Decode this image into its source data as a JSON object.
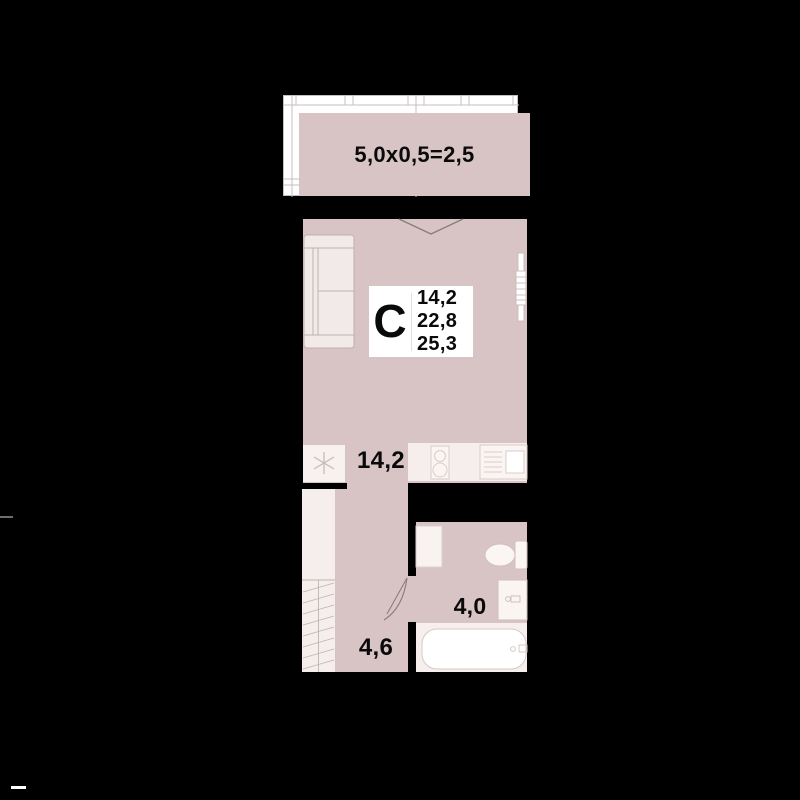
{
  "plan_title": "Studio apartment floor plan",
  "balcony": {
    "dimension_label": "5,0x0,5=2,5"
  },
  "unit_badge": {
    "type_letter": "С",
    "areas": [
      "14,2",
      "22,8",
      "25,3"
    ]
  },
  "rooms": {
    "living": {
      "area": "14,2"
    },
    "hallway": {
      "area": "4,6"
    },
    "bathroom": {
      "area": "4,0"
    }
  },
  "colors": {
    "background": "#000000",
    "room_fill": "#d8c4c4",
    "light_fill": "#f5eeec",
    "outline": "#c9bab8",
    "text": "#0a0a0a"
  }
}
